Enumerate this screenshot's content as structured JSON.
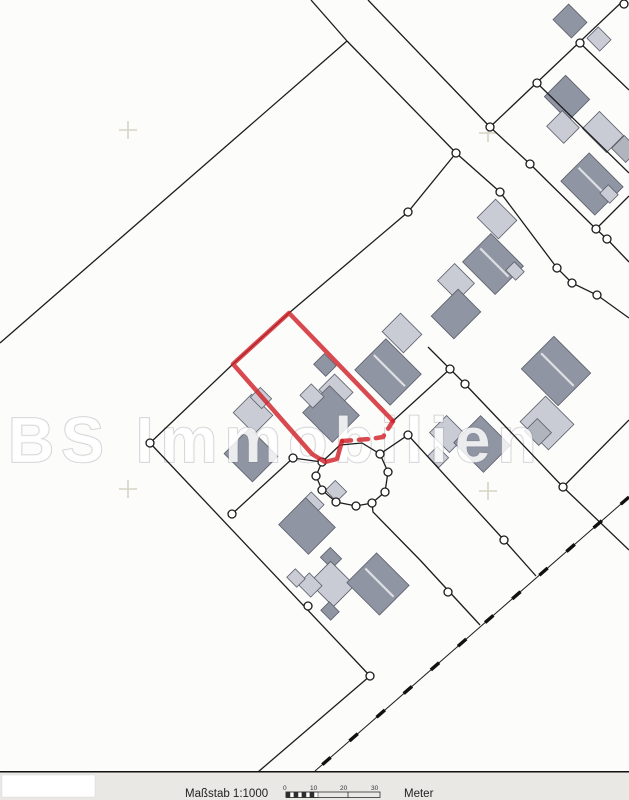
{
  "map": {
    "watermark": {
      "text": "BS Immobilien"
    },
    "colors": {
      "background": "#fcfcfb",
      "line": "#1c1c1c",
      "building_dark": "#9095a3",
      "building_light": "#c9ccd4",
      "building_mid": "#b0b4bd",
      "building_stroke": "#5a5d68",
      "red": "#d0222a",
      "cross": "#d6d3c6",
      "strip": "#eae8e5"
    },
    "crosses": [
      [
        128,
        130
      ],
      [
        488,
        133
      ],
      [
        128,
        489
      ],
      [
        488,
        491
      ]
    ],
    "polylines": [
      {
        "pts": [
          [
            311,
            0
          ],
          [
            347,
            41
          ]
        ]
      },
      {
        "pts": [
          [
            347,
            41
          ],
          [
            0,
            343
          ]
        ]
      },
      {
        "pts": [
          [
            347,
            41
          ],
          [
            456,
            153
          ],
          [
            500,
            192
          ],
          [
            557,
            268
          ],
          [
            572,
            283
          ],
          [
            597,
            295
          ],
          [
            629,
            318
          ]
        ]
      },
      {
        "pts": [
          [
            368,
            0
          ],
          [
            490,
            127
          ],
          [
            530,
            164
          ],
          [
            596,
            229
          ],
          [
            607,
            239
          ],
          [
            629,
            262
          ]
        ]
      },
      {
        "pts": [
          [
            490,
            127
          ],
          [
            626,
            -2
          ]
        ]
      },
      {
        "pts": [
          [
            537,
            83
          ],
          [
            629,
            173
          ]
        ]
      },
      {
        "pts": [
          [
            580,
            43
          ],
          [
            629,
            90
          ]
        ]
      },
      {
        "pts": [
          [
            596,
            229
          ],
          [
            629,
            196
          ]
        ]
      },
      {
        "pts": [
          [
            456,
            153
          ],
          [
            408,
            212
          ],
          [
            289,
            313
          ],
          [
            233,
            364
          ],
          [
            150,
            443
          ]
        ]
      },
      {
        "pts": [
          [
            150,
            443
          ],
          [
            370,
            676
          ]
        ]
      },
      {
        "pts": [
          [
            370,
            676
          ],
          [
            258,
            772
          ]
        ]
      },
      {
        "pts": [
          [
            232,
            514
          ],
          [
            293,
            458
          ],
          [
            322,
            462
          ]
        ]
      },
      {
        "pts": [
          [
            393,
            421
          ],
          [
            450,
            369
          ],
          [
            428,
            347
          ]
        ]
      },
      {
        "pts": [
          [
            450,
            369
          ],
          [
            465,
            384
          ],
          [
            563,
            487
          ],
          [
            629,
            550
          ]
        ]
      },
      {
        "pts": [
          [
            563,
            487
          ],
          [
            629,
            420
          ]
        ]
      },
      {
        "pts": [
          [
            322,
            462
          ],
          [
            316,
            476
          ],
          [
            322,
            490
          ],
          [
            336,
            502
          ],
          [
            356,
            506
          ],
          [
            372,
            503
          ],
          [
            385,
            492
          ],
          [
            388,
            472
          ],
          [
            380,
            454
          ],
          [
            362,
            443
          ],
          [
            340,
            445
          ],
          [
            322,
            462
          ]
        ]
      },
      {
        "pts": [
          [
            380,
            454
          ],
          [
            408,
            435
          ],
          [
            504,
            540
          ],
          [
            536,
            576
          ]
        ]
      },
      {
        "pts": [
          [
            372,
            503
          ],
          [
            373,
            512
          ],
          [
            420,
            560
          ],
          [
            480,
            625
          ]
        ]
      }
    ],
    "dashed_line": {
      "pts": [
        [
          629,
          497
        ],
        [
          315,
          771
        ]
      ]
    },
    "red_parcel": {
      "solid": [
        [
          393,
          421
        ],
        [
          289,
          313
        ],
        [
          233,
          364
        ],
        [
          312,
          454
        ],
        [
          325,
          462
        ],
        [
          337,
          459
        ],
        [
          342,
          441
        ]
      ],
      "dashed": [
        [
          342,
          441
        ],
        [
          370,
          439
        ],
        [
          383,
          437
        ],
        [
          393,
          421
        ]
      ]
    },
    "circles": [
      [
        456,
        153
      ],
      [
        500,
        192
      ],
      [
        557,
        268
      ],
      [
        572,
        283
      ],
      [
        597,
        295
      ],
      [
        490,
        127
      ],
      [
        530,
        164
      ],
      [
        596,
        229
      ],
      [
        607,
        239
      ],
      [
        537,
        83
      ],
      [
        580,
        43
      ],
      [
        624,
        4
      ],
      [
        408,
        212
      ],
      [
        150,
        443
      ],
      [
        232,
        514
      ],
      [
        370,
        676
      ],
      [
        293,
        458
      ],
      [
        322,
        462
      ],
      [
        316,
        476
      ],
      [
        322,
        490
      ],
      [
        336,
        502
      ],
      [
        356,
        506
      ],
      [
        372,
        503
      ],
      [
        385,
        492
      ],
      [
        388,
        472
      ],
      [
        380,
        454
      ],
      [
        408,
        435
      ],
      [
        504,
        540
      ],
      [
        448,
        592
      ],
      [
        308,
        606
      ],
      [
        450,
        369
      ],
      [
        465,
        384
      ],
      [
        563,
        487
      ]
    ],
    "buildings": [
      {
        "c": [
          570,
          21
        ],
        "s": [
          26,
          22
        ],
        "f": "dark"
      },
      {
        "c": [
          599,
          39
        ],
        "s": [
          18,
          16
        ],
        "f": "light"
      },
      {
        "c": [
          567,
          98
        ],
        "s": [
          34,
          30
        ],
        "f": "dark"
      },
      {
        "c": [
          563,
          127
        ],
        "s": [
          24,
          22
        ],
        "f": "light"
      },
      {
        "c": [
          603,
          132
        ],
        "s": [
          34,
          24
        ],
        "f": "light"
      },
      {
        "c": [
          625,
          149
        ],
        "s": [
          20,
          18
        ],
        "f": "mid"
      },
      {
        "c": [
          592,
          184
        ],
        "s": [
          48,
          40
        ],
        "f": "dark",
        "st": 1
      },
      {
        "c": [
          609,
          194
        ],
        "s": [
          14,
          12
        ],
        "f": "light"
      },
      {
        "c": [
          497,
          219
        ],
        "s": [
          30,
          26
        ],
        "f": "light"
      },
      {
        "c": [
          493,
          264
        ],
        "s": [
          46,
          40
        ],
        "f": "dark",
        "st": 1
      },
      {
        "c": [
          515,
          271
        ],
        "s": [
          14,
          12
        ],
        "f": "light"
      },
      {
        "c": [
          456,
          282
        ],
        "s": [
          28,
          24
        ],
        "f": "light"
      },
      {
        "c": [
          456,
          314
        ],
        "s": [
          32,
          38
        ],
        "f": "dark"
      },
      {
        "c": [
          556,
          371
        ],
        "s": [
          52,
          46
        ],
        "f": "dark",
        "st": 1
      },
      {
        "c": [
          547,
          423
        ],
        "s": [
          40,
          36
        ],
        "f": "light"
      },
      {
        "c": [
          538,
          432
        ],
        "s": [
          20,
          18
        ],
        "f": "mid"
      },
      {
        "c": [
          402,
          333
        ],
        "s": [
          30,
          26
        ],
        "f": "light"
      },
      {
        "c": [
          388,
          372
        ],
        "s": [
          50,
          44
        ],
        "f": "dark",
        "st": 1
      },
      {
        "c": [
          325,
          365
        ],
        "s": [
          17,
          15
        ],
        "f": "dark"
      },
      {
        "c": [
          336,
          391
        ],
        "s": [
          26,
          22
        ],
        "f": "light"
      },
      {
        "c": [
          331,
          414
        ],
        "s": [
          42,
          38
        ],
        "f": "dark"
      },
      {
        "c": [
          312,
          396
        ],
        "s": [
          18,
          16
        ],
        "f": "light"
      },
      {
        "c": [
          253,
          414
        ],
        "s": [
          30,
          26
        ],
        "f": "light"
      },
      {
        "c": [
          261,
          398
        ],
        "s": [
          16,
          14
        ],
        "f": "light"
      },
      {
        "c": [
          251,
          455
        ],
        "s": [
          40,
          36
        ],
        "f": "dark"
      },
      {
        "c": [
          312,
          504
        ],
        "s": [
          18,
          16
        ],
        "f": "light"
      },
      {
        "c": [
          307,
          526
        ],
        "s": [
          42,
          38
        ],
        "f": "dark"
      },
      {
        "c": [
          336,
          491
        ],
        "s": [
          16,
          14
        ],
        "f": "light"
      },
      {
        "c": [
          331,
          558
        ],
        "s": [
          16,
          14
        ],
        "f": "dark"
      },
      {
        "c": [
          332,
          584
        ],
        "s": [
          34,
          30
        ],
        "f": "light"
      },
      {
        "c": [
          310,
          585
        ],
        "s": [
          18,
          16
        ],
        "f": "light"
      },
      {
        "c": [
          378,
          584
        ],
        "s": [
          46,
          42
        ],
        "f": "dark",
        "st": 1
      },
      {
        "c": [
          296,
          578
        ],
        "s": [
          14,
          12
        ],
        "f": "light"
      },
      {
        "c": [
          448,
          434
        ],
        "s": [
          28,
          24
        ],
        "f": "light"
      },
      {
        "c": [
          482,
          444
        ],
        "s": [
          42,
          38
        ],
        "f": "dark"
      },
      {
        "c": [
          438,
          457
        ],
        "s": [
          16,
          14
        ],
        "f": "light"
      },
      {
        "c": [
          330,
          611
        ],
        "s": [
          14,
          12
        ],
        "f": "dark"
      }
    ]
  },
  "footer": {
    "scale_label": "Maßstab 1:1000",
    "unit_label": "Meter",
    "ticks": [
      "0",
      "10",
      "20",
      "30"
    ]
  }
}
